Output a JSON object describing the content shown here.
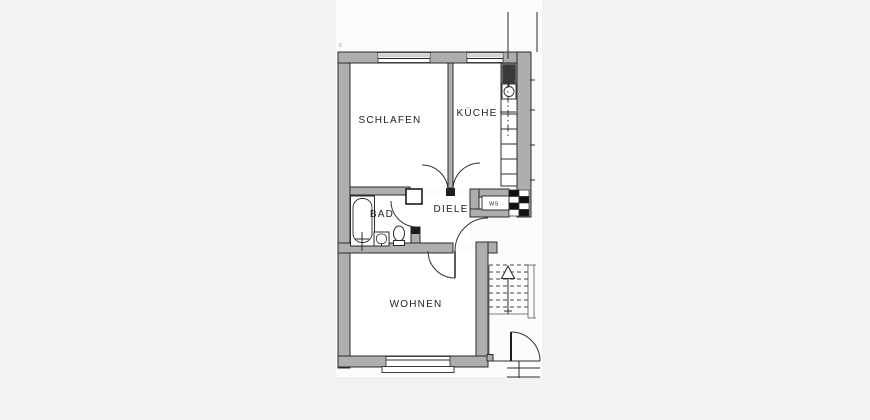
{
  "plan": {
    "type": "apartment-floor-plan",
    "annotation_mark": "c",
    "rooms": [
      {
        "id": "schlafen",
        "label": "SCHLAFEN"
      },
      {
        "id": "kueche",
        "label": "KÜCHE"
      },
      {
        "id": "bad",
        "label": "BAD"
      },
      {
        "id": "diele",
        "label": "DIELE"
      },
      {
        "id": "wohnen",
        "label": "WOHNEN"
      },
      {
        "id": "ws",
        "label": "WS"
      }
    ],
    "fixtures": [
      "bathtub",
      "washbasin",
      "toilet",
      "stove",
      "kitchen-sink",
      "kitchen-counter",
      "chimney",
      "wall-closet",
      "staircase",
      "stair-direction-arrow",
      "apartment-entrance-door",
      "building-entrance-door",
      "windows",
      "section-line"
    ],
    "colors": {
      "background": "#f2f2f2",
      "paper": "#fcfcfc",
      "wall_fill": "#aeaeae",
      "outline": "#2b2b2b",
      "window_sill": "#d2d2d2",
      "stove_fill": "#3a3a3a",
      "text": "#222222"
    }
  }
}
